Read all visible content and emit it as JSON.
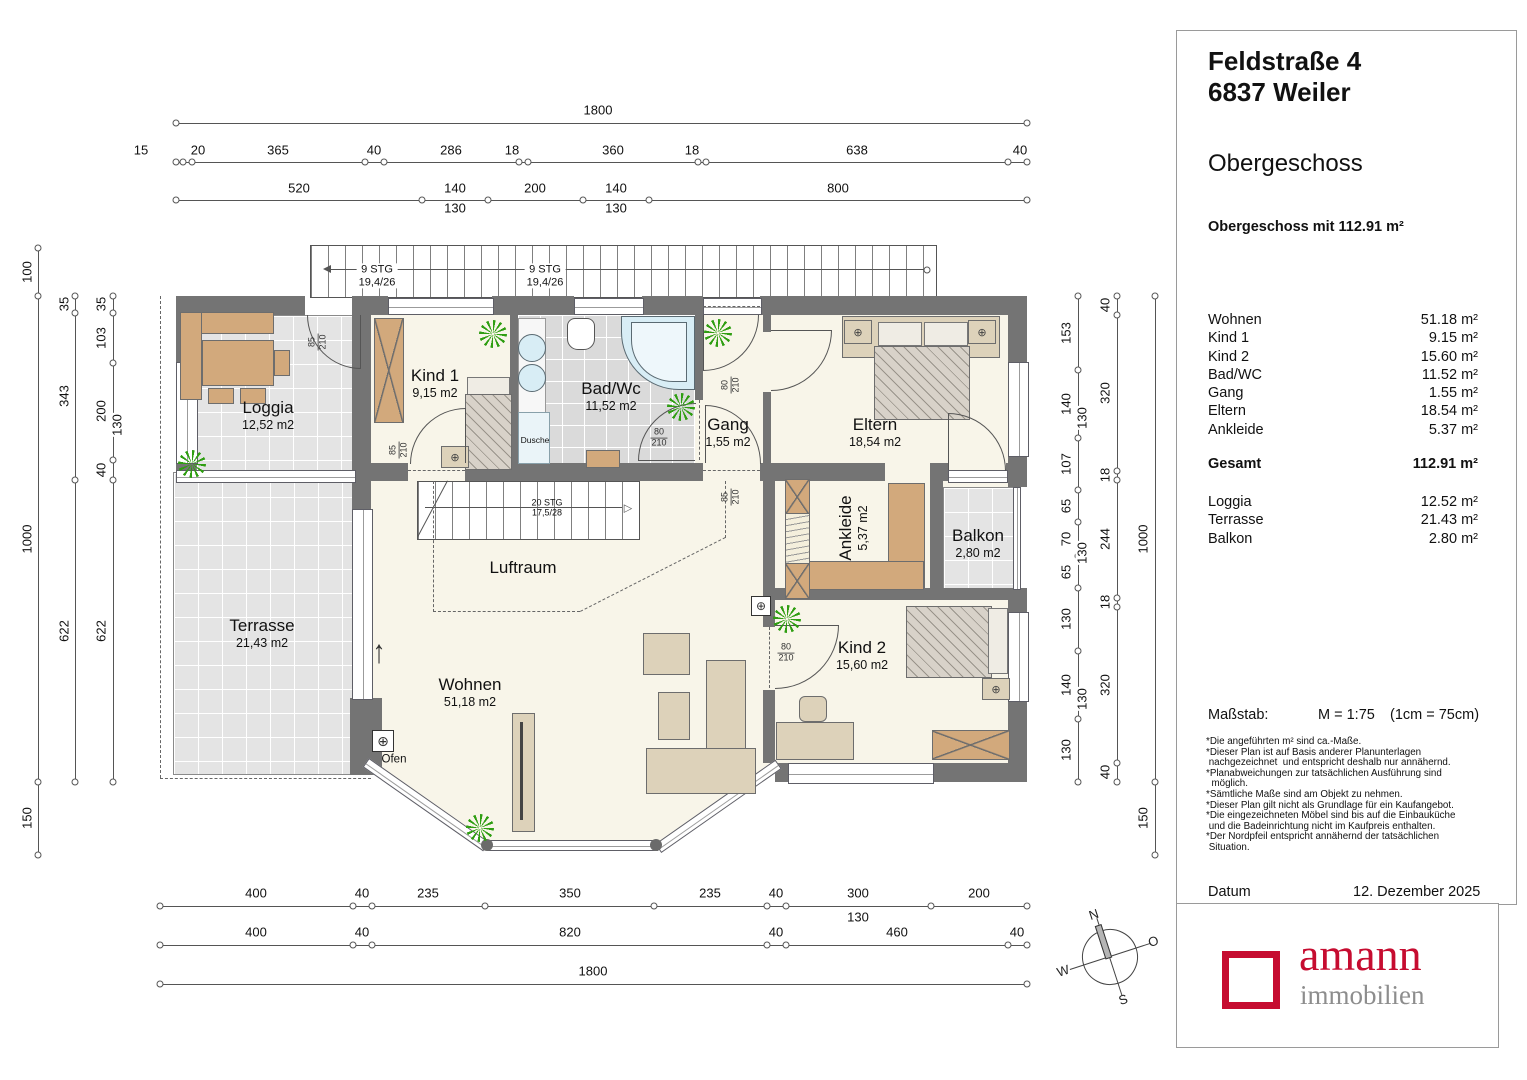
{
  "panel": {
    "address_line1": "Feldstraße 4",
    "address_line2": "6837 Weiler",
    "floor_title": "Obergeschoss",
    "floor_subtitle": "Obergeschoss mit 112.91 m²",
    "rooms": [
      {
        "label": "Wohnen",
        "value": "51.18 m²"
      },
      {
        "label": "Kind 1",
        "value": "9.15 m²"
      },
      {
        "label": "Kind 2",
        "value": "15.60 m²"
      },
      {
        "label": "Bad/WC",
        "value": "11.52 m²"
      },
      {
        "label": "Gang",
        "value": "1.55 m²"
      },
      {
        "label": "Eltern",
        "value": "18.54 m²"
      },
      {
        "label": "Ankleide",
        "value": "5.37 m²"
      }
    ],
    "total": {
      "label": "Gesamt",
      "value": "112.91 m²"
    },
    "outdoor": [
      {
        "label": "Loggia",
        "value": "12.52 m²"
      },
      {
        "label": "Terrasse",
        "value": "21.43 m²"
      },
      {
        "label": "Balkon",
        "value": "2.80 m²"
      }
    ],
    "scale_label": "Maßstab:",
    "scale_value": "M = 1:75",
    "scale_note": "(1cm = 75cm)",
    "footnotes": [
      {
        "t": "*Die angeführten m² sind ca.-Maße."
      },
      {
        "t": "*Dieser Plan ist auf Basis anderer Planunterlagen"
      },
      {
        "t": " nachgezeichnet  und entspricht deshalb nur annähernd."
      },
      {
        "t": "*Planabweichungen zur tatsächlichen Ausführung sind"
      },
      {
        "t": "  möglich."
      },
      {
        "t": "*Sämtliche Maße sind am Objekt zu nehmen."
      },
      {
        "t": "*Dieser Plan gilt nicht als Grundlage für ein Kaufangebot."
      },
      {
        "t": "*Die eingezeichneten Möbel sind bis auf die Einbauküche"
      },
      {
        "t": " und die Badeinrichtung nicht im Kaufpreis enthalten."
      },
      {
        "t": "*Der Nordpfeil entspricht annähernd der tatsächlichen"
      },
      {
        "t": " Situation."
      }
    ],
    "date_label": "Datum",
    "date_value": "12. Dezember 2025"
  },
  "logo": {
    "name": "amann",
    "subtitle": "immobilien",
    "accent_color": "#c60c30",
    "gray_color": "#8d8d8d"
  },
  "compass": {
    "n": "N",
    "o": "O",
    "s": "S",
    "w": "W"
  },
  "plan": {
    "rooms": [
      {
        "name": "Loggia",
        "area": "12,52 m2",
        "x": 268,
        "y": 415
      },
      {
        "name": "Terrasse",
        "area": "21,43 m2",
        "x": 262,
        "y": 633
      },
      {
        "name": "Kind 1",
        "area": "9,15 m2",
        "x": 435,
        "y": 383
      },
      {
        "name": "Bad/Wc",
        "area": "11,52 m2",
        "x": 611,
        "y": 396
      },
      {
        "name": "Gang",
        "area": "1,55 m2",
        "x": 728,
        "y": 432
      },
      {
        "name": "Eltern",
        "area": "18,54 m2",
        "x": 875,
        "y": 432
      },
      {
        "name": "Ankleide",
        "area": "5,37 m2",
        "x": 853,
        "y": 528,
        "rot": 1
      },
      {
        "name": "Balkon",
        "area": "2,80 m2",
        "x": 978,
        "y": 543
      },
      {
        "name": "Kind 2",
        "area": "15,60 m2",
        "x": 862,
        "y": 655
      },
      {
        "name": "Wohnen",
        "area": "51,18 m2",
        "x": 470,
        "y": 692
      },
      {
        "name": "Luftraum",
        "area": "",
        "x": 523,
        "y": 568
      },
      {
        "name": "Dusche",
        "area": "",
        "x": 535,
        "y": 441,
        "cls": "tiny"
      },
      {
        "name": "Ofen",
        "area": "",
        "x": 394,
        "y": 760,
        "cls": "tiny2"
      }
    ],
    "stairs": [
      {
        "l1": "9 STG",
        "l2": "19,4/26",
        "x": 377,
        "y": 276
      },
      {
        "l1": "9 STG",
        "l2": "19,4/26",
        "x": 545,
        "y": 276
      },
      {
        "l1": "20 STG",
        "l2": "17,5/28",
        "x": 547,
        "y": 508,
        "cls": "xs"
      }
    ],
    "door_labels": [
      {
        "num": "85",
        "den": "210",
        "x": 318,
        "y": 342,
        "rot": 1
      },
      {
        "num": "85",
        "den": "210",
        "x": 399,
        "y": 450,
        "rot": 1
      },
      {
        "num": "80",
        "den": "210",
        "x": 659,
        "y": 438
      },
      {
        "num": "80",
        "den": "210",
        "x": 731,
        "y": 385,
        "rot": 1
      },
      {
        "num": "85",
        "den": "210",
        "x": 731,
        "y": 497,
        "rot": 1
      },
      {
        "num": "80",
        "den": "210",
        "x": 786,
        "y": 653
      }
    ],
    "dims": [
      {
        "t": "1800",
        "x": 598,
        "y": 110
      },
      {
        "t": "15",
        "x": 141,
        "y": 150
      },
      {
        "t": "20",
        "x": 198,
        "y": 150
      },
      {
        "t": "365",
        "x": 278,
        "y": 150
      },
      {
        "t": "40",
        "x": 374,
        "y": 150
      },
      {
        "t": "286",
        "x": 451,
        "y": 150
      },
      {
        "t": "18",
        "x": 512,
        "y": 150
      },
      {
        "t": "360",
        "x": 613,
        "y": 150
      },
      {
        "t": "18",
        "x": 692,
        "y": 150
      },
      {
        "t": "638",
        "x": 857,
        "y": 150
      },
      {
        "t": "40",
        "x": 1020,
        "y": 150
      },
      {
        "t": "520",
        "x": 299,
        "y": 188
      },
      {
        "t": "140",
        "x": 455,
        "y": 188
      },
      {
        "t": "200",
        "x": 535,
        "y": 188
      },
      {
        "t": "140",
        "x": 616,
        "y": 188
      },
      {
        "t": "800",
        "x": 838,
        "y": 188
      },
      {
        "t": "130",
        "x": 455,
        "y": 208
      },
      {
        "t": "130",
        "x": 616,
        "y": 208
      },
      {
        "t": "400",
        "x": 256,
        "y": 893
      },
      {
        "t": "40",
        "x": 362,
        "y": 893
      },
      {
        "t": "235",
        "x": 428,
        "y": 893
      },
      {
        "t": "350",
        "x": 570,
        "y": 893
      },
      {
        "t": "235",
        "x": 710,
        "y": 893
      },
      {
        "t": "40",
        "x": 776,
        "y": 893
      },
      {
        "t": "300",
        "x": 858,
        "y": 893
      },
      {
        "t": "200",
        "x": 979,
        "y": 893
      },
      {
        "t": "130",
        "x": 858,
        "y": 917
      },
      {
        "t": "400",
        "x": 256,
        "y": 932
      },
      {
        "t": "40",
        "x": 362,
        "y": 932
      },
      {
        "t": "820",
        "x": 570,
        "y": 932
      },
      {
        "t": "40",
        "x": 776,
        "y": 932
      },
      {
        "t": "460",
        "x": 897,
        "y": 932
      },
      {
        "t": "40",
        "x": 1017,
        "y": 932
      },
      {
        "t": "1800",
        "x": 593,
        "y": 971
      },
      {
        "t": "100",
        "x": 27,
        "y": 272,
        "rot": 1
      },
      {
        "t": "1000",
        "x": 27,
        "y": 539,
        "rot": 1
      },
      {
        "t": "150",
        "x": 27,
        "y": 818,
        "rot": 1
      },
      {
        "t": "35",
        "x": 64,
        "y": 304,
        "rot": 1
      },
      {
        "t": "343",
        "x": 64,
        "y": 396,
        "rot": 1
      },
      {
        "t": "622",
        "x": 64,
        "y": 631,
        "rot": 1
      },
      {
        "t": "35",
        "x": 101,
        "y": 304,
        "rot": 1
      },
      {
        "t": "103",
        "x": 101,
        "y": 338,
        "rot": 1
      },
      {
        "t": "200",
        "x": 101,
        "y": 411,
        "rot": 1
      },
      {
        "t": "130",
        "x": 117,
        "y": 425,
        "rot": 1
      },
      {
        "t": "40",
        "x": 101,
        "y": 470,
        "rot": 1
      },
      {
        "t": "622",
        "x": 101,
        "y": 631,
        "rot": 1
      },
      {
        "t": "153",
        "x": 1066,
        "y": 333,
        "rot": 1
      },
      {
        "t": "140",
        "x": 1066,
        "y": 404,
        "rot": 1
      },
      {
        "t": "130",
        "x": 1082,
        "y": 418,
        "rot": 1
      },
      {
        "t": "107",
        "x": 1066,
        "y": 464,
        "rot": 1
      },
      {
        "t": "65",
        "x": 1066,
        "y": 506,
        "rot": 1
      },
      {
        "t": "70",
        "x": 1066,
        "y": 539,
        "rot": 1
      },
      {
        "t": "130",
        "x": 1082,
        "y": 553,
        "rot": 1
      },
      {
        "t": "65",
        "x": 1066,
        "y": 572,
        "rot": 1
      },
      {
        "t": "130",
        "x": 1066,
        "y": 619,
        "rot": 1
      },
      {
        "t": "140",
        "x": 1066,
        "y": 685,
        "rot": 1
      },
      {
        "t": "130",
        "x": 1082,
        "y": 699,
        "rot": 1
      },
      {
        "t": "130",
        "x": 1066,
        "y": 750,
        "rot": 1
      },
      {
        "t": "40",
        "x": 1105,
        "y": 305,
        "rot": 1
      },
      {
        "t": "320",
        "x": 1105,
        "y": 393,
        "rot": 1
      },
      {
        "t": "18",
        "x": 1105,
        "y": 475,
        "rot": 1
      },
      {
        "t": "244",
        "x": 1105,
        "y": 539,
        "rot": 1
      },
      {
        "t": "18",
        "x": 1105,
        "y": 602,
        "rot": 1
      },
      {
        "t": "320",
        "x": 1105,
        "y": 685,
        "rot": 1
      },
      {
        "t": "40",
        "x": 1105,
        "y": 772,
        "rot": 1
      },
      {
        "t": "1000",
        "x": 1143,
        "y": 539,
        "rot": 1
      },
      {
        "t": "150",
        "x": 1143,
        "y": 818,
        "rot": 1
      }
    ],
    "ticks": [
      {
        "x": 176,
        "y": 123
      },
      {
        "x": 1027,
        "y": 123
      },
      {
        "x": 176,
        "y": 162
      },
      {
        "x": 183,
        "y": 162
      },
      {
        "x": 192,
        "y": 162
      },
      {
        "x": 365,
        "y": 162
      },
      {
        "x": 384,
        "y": 162
      },
      {
        "x": 519,
        "y": 162
      },
      {
        "x": 528,
        "y": 162
      },
      {
        "x": 698,
        "y": 162
      },
      {
        "x": 706,
        "y": 162
      },
      {
        "x": 1008,
        "y": 162
      },
      {
        "x": 1027,
        "y": 162
      },
      {
        "x": 176,
        "y": 200
      },
      {
        "x": 422,
        "y": 200
      },
      {
        "x": 488,
        "y": 200
      },
      {
        "x": 583,
        "y": 200
      },
      {
        "x": 649,
        "y": 200
      },
      {
        "x": 1027,
        "y": 200
      },
      {
        "x": 160,
        "y": 906
      },
      {
        "x": 353,
        "y": 906
      },
      {
        "x": 372,
        "y": 906
      },
      {
        "x": 485,
        "y": 906
      },
      {
        "x": 654,
        "y": 906
      },
      {
        "x": 767,
        "y": 906
      },
      {
        "x": 786,
        "y": 906
      },
      {
        "x": 931,
        "y": 906
      },
      {
        "x": 1027,
        "y": 906
      },
      {
        "x": 160,
        "y": 945
      },
      {
        "x": 353,
        "y": 945
      },
      {
        "x": 372,
        "y": 945
      },
      {
        "x": 767,
        "y": 945
      },
      {
        "x": 786,
        "y": 945
      },
      {
        "x": 1008,
        "y": 945
      },
      {
        "x": 1027,
        "y": 945
      },
      {
        "x": 160,
        "y": 984
      },
      {
        "x": 1027,
        "y": 984
      },
      {
        "x": 38,
        "y": 248
      },
      {
        "x": 38,
        "y": 296
      },
      {
        "x": 38,
        "y": 782
      },
      {
        "x": 38,
        "y": 855
      },
      {
        "x": 75,
        "y": 296
      },
      {
        "x": 75,
        "y": 313
      },
      {
        "x": 75,
        "y": 480
      },
      {
        "x": 75,
        "y": 782
      },
      {
        "x": 113,
        "y": 296
      },
      {
        "x": 113,
        "y": 313
      },
      {
        "x": 113,
        "y": 363
      },
      {
        "x": 113,
        "y": 460
      },
      {
        "x": 113,
        "y": 480
      },
      {
        "x": 113,
        "y": 782
      },
      {
        "x": 1078,
        "y": 296
      },
      {
        "x": 1078,
        "y": 370
      },
      {
        "x": 1078,
        "y": 438
      },
      {
        "x": 1078,
        "y": 490
      },
      {
        "x": 1078,
        "y": 522
      },
      {
        "x": 1078,
        "y": 556
      },
      {
        "x": 1078,
        "y": 588
      },
      {
        "x": 1078,
        "y": 651
      },
      {
        "x": 1078,
        "y": 719
      },
      {
        "x": 1078,
        "y": 782
      },
      {
        "x": 1117,
        "y": 296
      },
      {
        "x": 1117,
        "y": 315
      },
      {
        "x": 1117,
        "y": 471
      },
      {
        "x": 1117,
        "y": 480
      },
      {
        "x": 1117,
        "y": 598
      },
      {
        "x": 1117,
        "y": 607
      },
      {
        "x": 1117,
        "y": 763
      },
      {
        "x": 1117,
        "y": 782
      },
      {
        "x": 1155,
        "y": 296
      },
      {
        "x": 1155,
        "y": 782
      },
      {
        "x": 1155,
        "y": 855
      }
    ],
    "plants": [
      {
        "x": 192,
        "y": 464
      },
      {
        "x": 493,
        "y": 334
      },
      {
        "x": 681,
        "y": 407
      },
      {
        "x": 718,
        "y": 333
      },
      {
        "x": 787,
        "y": 619
      },
      {
        "x": 480,
        "y": 828
      }
    ]
  }
}
